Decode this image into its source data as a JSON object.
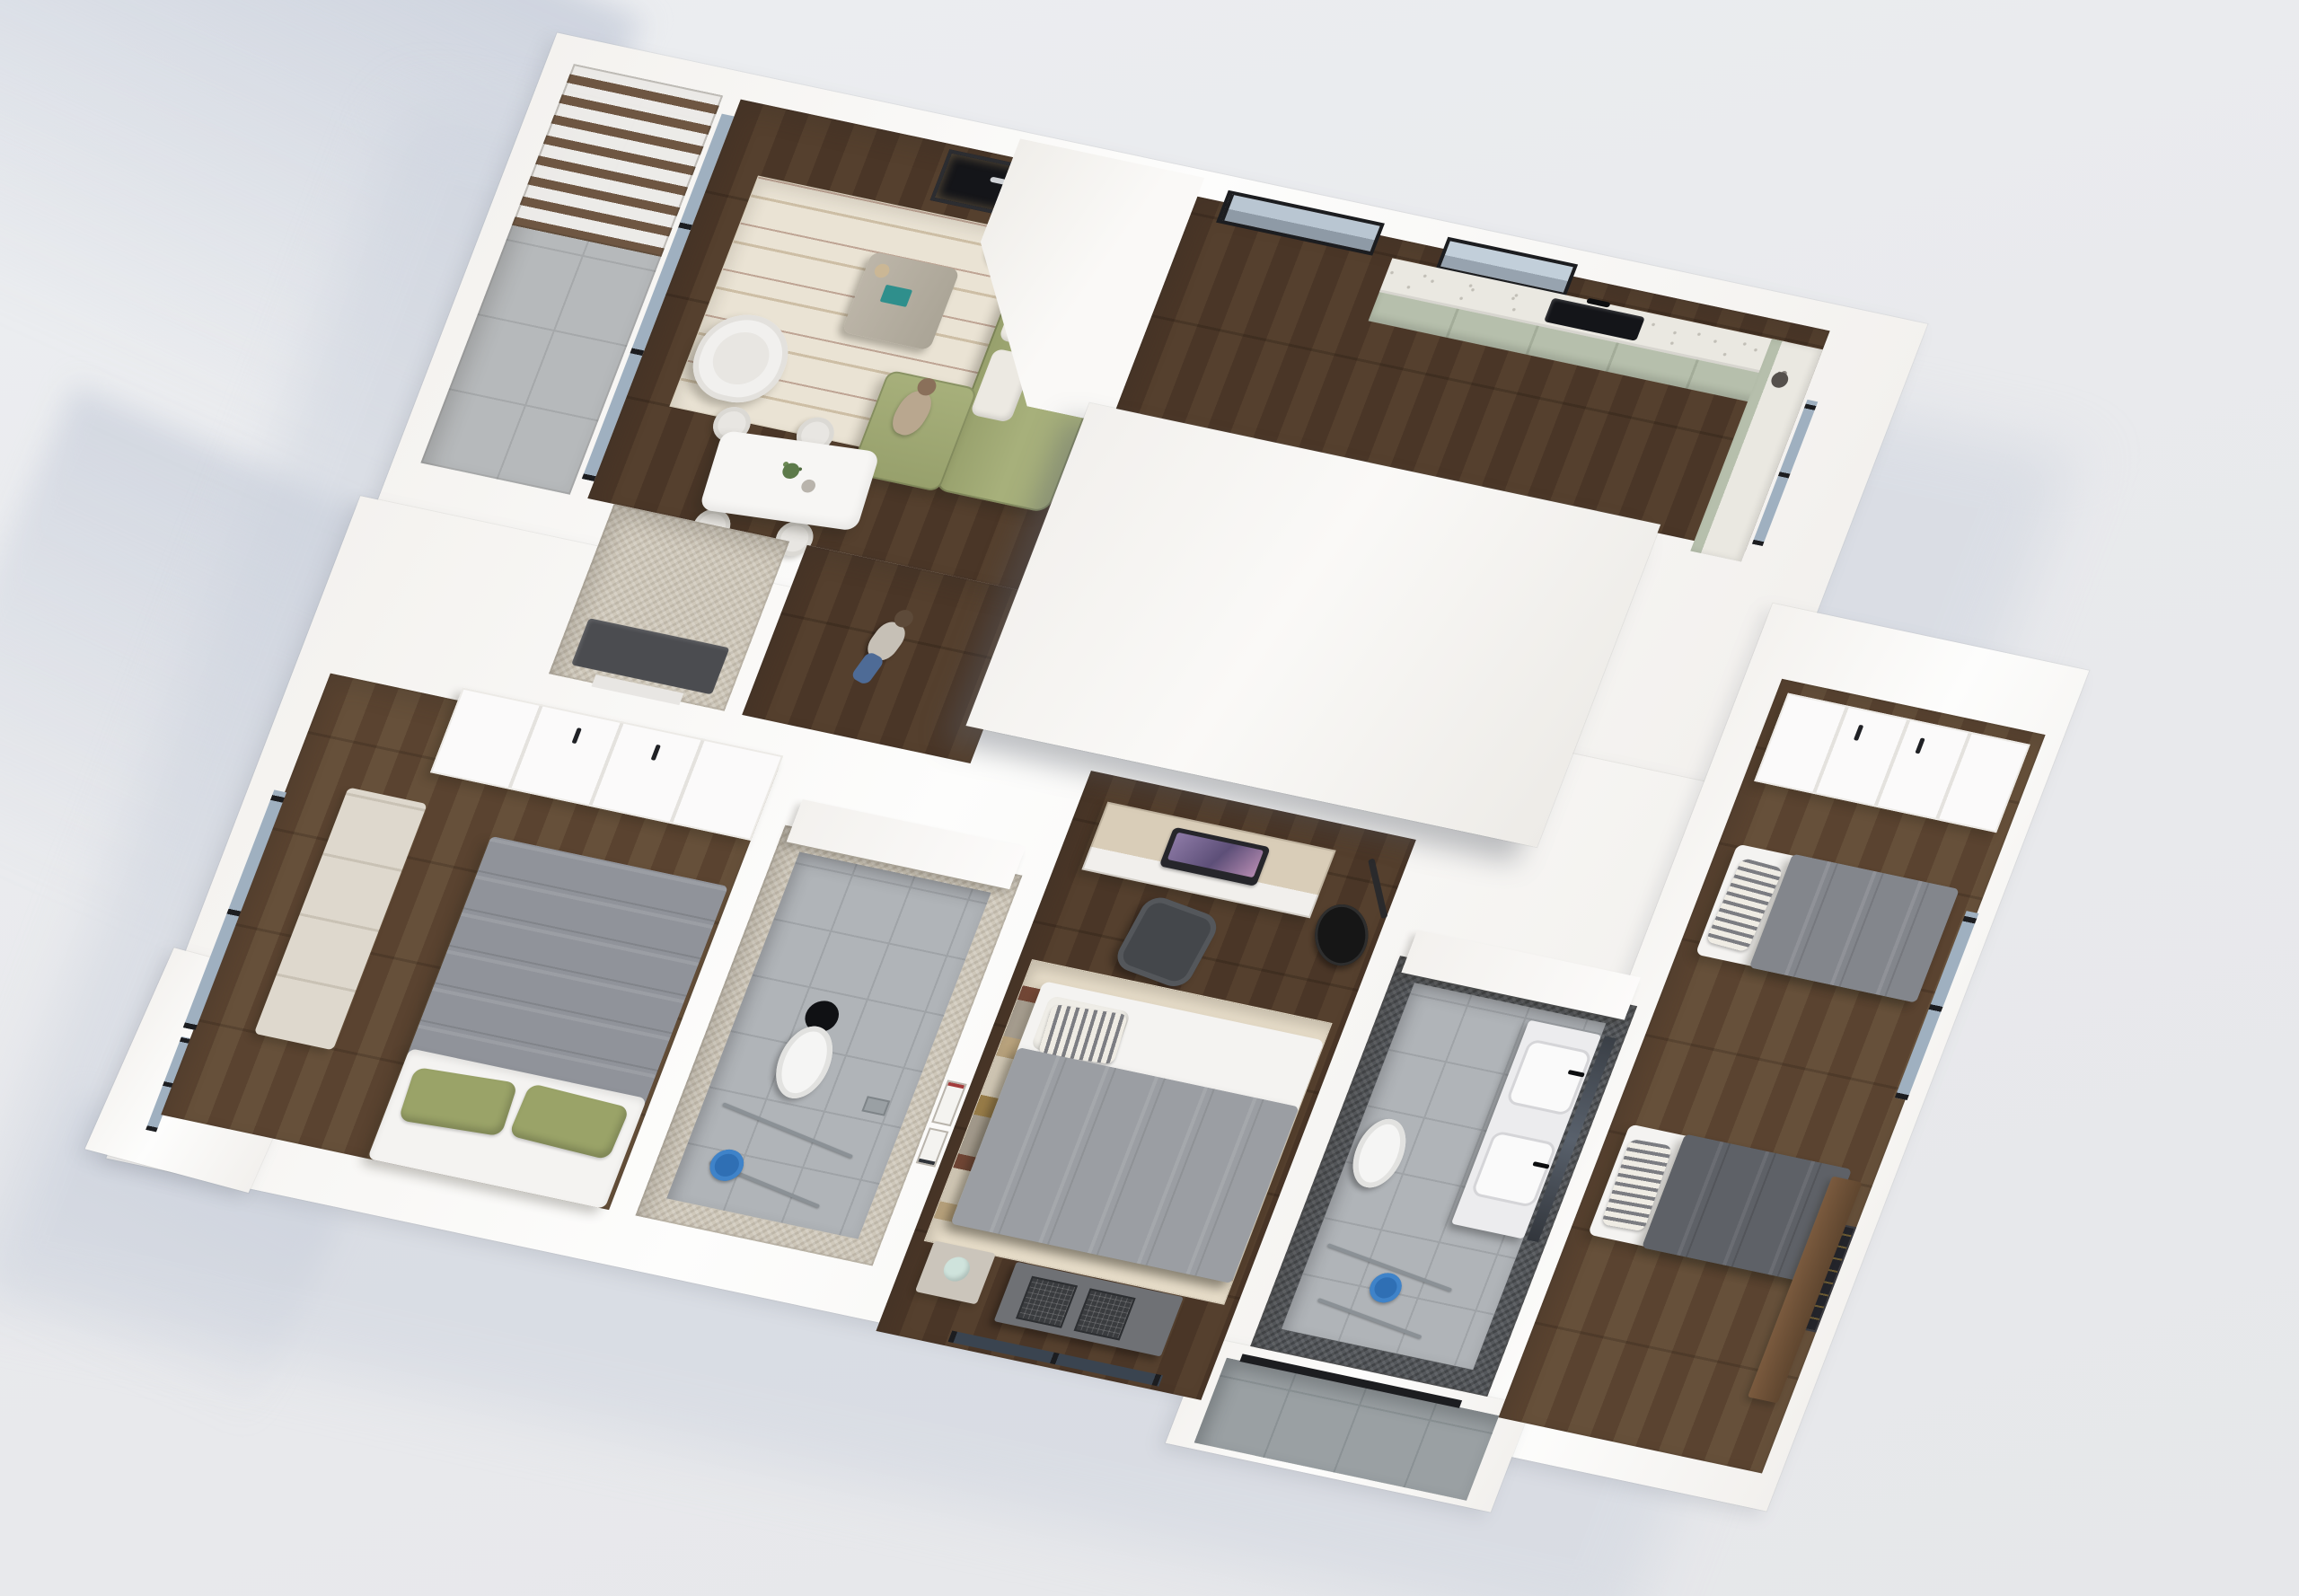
{
  "meta": {
    "title": "3D rendered floor plan — top-down dollhouse view of a three-bedroom apartment"
  },
  "palette": {
    "bg": "#e9eaed",
    "shadowCast": "#ccd2dd",
    "slab": "#fbfafa",
    "roof": "#f2f0ed",
    "roofLight": "#faf9f7",
    "plankA": "#4a3627",
    "plankB": "#55402e",
    "plankC": "#5a4330",
    "plankD": "#66503a",
    "concrete": "#b6b9bb",
    "concreteLine": "#a5a8aa",
    "pergola": "#6e5642",
    "glass": "#9fb0c0",
    "frame": "#1c1d20",
    "rugCream": "#eae3d4",
    "sofa": "#a7b07b",
    "sofaDark": "#97a06c",
    "cushion": "#ece9e2",
    "teal": "#2f8f8c",
    "sage": "#b6bfac",
    "terrazzo": "#eae8e1",
    "black": "#141519",
    "duvet1": "#90939a",
    "duvet2": "#9b9ea3",
    "duvet3": "#83868c",
    "duvetDark": "#5e6167",
    "mattress": "#f4f3f1",
    "pillowGreen": "#9aa368",
    "stripeLight": "#efece4",
    "stripeDark": "#7c7d82",
    "mosaicBeige": "#cfc8ba",
    "mosaicDark": "#55585c",
    "tile": "#b0b4b8",
    "tileLine": "#9fa3a7",
    "vanity": "#ececee",
    "blue": "#2f6fb4",
    "deskWood": "#d9cdb8",
    "chairDark": "#44474b",
    "guitar": "#161616",
    "mint": "#cfe3dc",
    "boho1": "#e7ddc9",
    "boho2": "#cab289",
    "boho3": "#a8894f",
    "boho4": "#7b4b39",
    "boho5": "#b4ab9c",
    "patio": "#9aa0a3",
    "patioLine": "#8a9194",
    "art": "#23242a",
    "consoleWood": "#7a5a3e"
  },
  "rooms": {
    "balcony": {
      "label": "Balcony with slatted pergola"
    },
    "living": {
      "label": "Living room"
    },
    "dining": {
      "label": "Dining area"
    },
    "kitchen": {
      "label": "Kitchen"
    },
    "hallway": {
      "label": "Hallway"
    },
    "laundry": {
      "label": "Laundry / utility room"
    },
    "bedroom1": {
      "label": "Bedroom 1"
    },
    "bathroom1": {
      "label": "Bathroom 1"
    },
    "bedroom2": {
      "label": "Bedroom 2"
    },
    "bathroom2": {
      "label": "Bathroom 2"
    },
    "bedroom3": {
      "label": "Bedroom 3 (twin beds)"
    },
    "patio": {
      "label": "Concrete-tiled entry patio"
    },
    "roof": {
      "label": "Flat roof section"
    }
  },
  "furniture": {
    "pergola": "Slatted wood pergola",
    "balcony_glass": "Sliding glass wall to balcony",
    "fireplace": "Recessed fireplace",
    "bench": "Bench with chevron pillows",
    "rug_living": "Patterned cream area rug",
    "sofa": "Green L-shaped sofa",
    "armchair": "White armchair",
    "coffee_table": "Coffee table with teal book",
    "floor_lamp": "Black floor lamp",
    "dining_table": "White dining table with plant",
    "dining_chair": "Dining chair",
    "sliding_door": "Sliding glass door",
    "window": "Window",
    "kitchen_counter": "Sage-green kitchen counter with terrazzo top",
    "sink": "Black kitchen sink with faucet",
    "counter_right": "Side counter with vase",
    "wardrobe": "White wardrobe with black handles",
    "dresser": "Dresser",
    "double_bed": "Double bed with grey duvet and green pillows",
    "ledge": "Half-wall ledge",
    "toilet": "Toilet",
    "shower": "Walk-in shower fixtures",
    "bucket": "Blue bucket",
    "drain": "Shower drain",
    "desk": "Desk with all-in-one computer",
    "office_chair": "Office chair",
    "guitar": "Black acoustic guitar",
    "wall_frames": "Small framed pictures",
    "rug_boho": "Striped boho rug",
    "bed_grey": "Bed with grey duvet and striped pillow",
    "nightstand": "Nightstand with mint lamp",
    "storage_dresser": "Dresser with wire baskets",
    "vanity": "Double-sink vanity with mirror",
    "stool": "Blue shower stool",
    "single_bed": "Single bed with grey duvet",
    "wall_art": "Framed city-lights wall art",
    "console": "Wooden console",
    "threshold": "Glass door track",
    "person_walking": "Person walking in hallway",
    "person_sitting": "Person seated on sofa",
    "laundry_counter": "Dark utility counter"
  }
}
